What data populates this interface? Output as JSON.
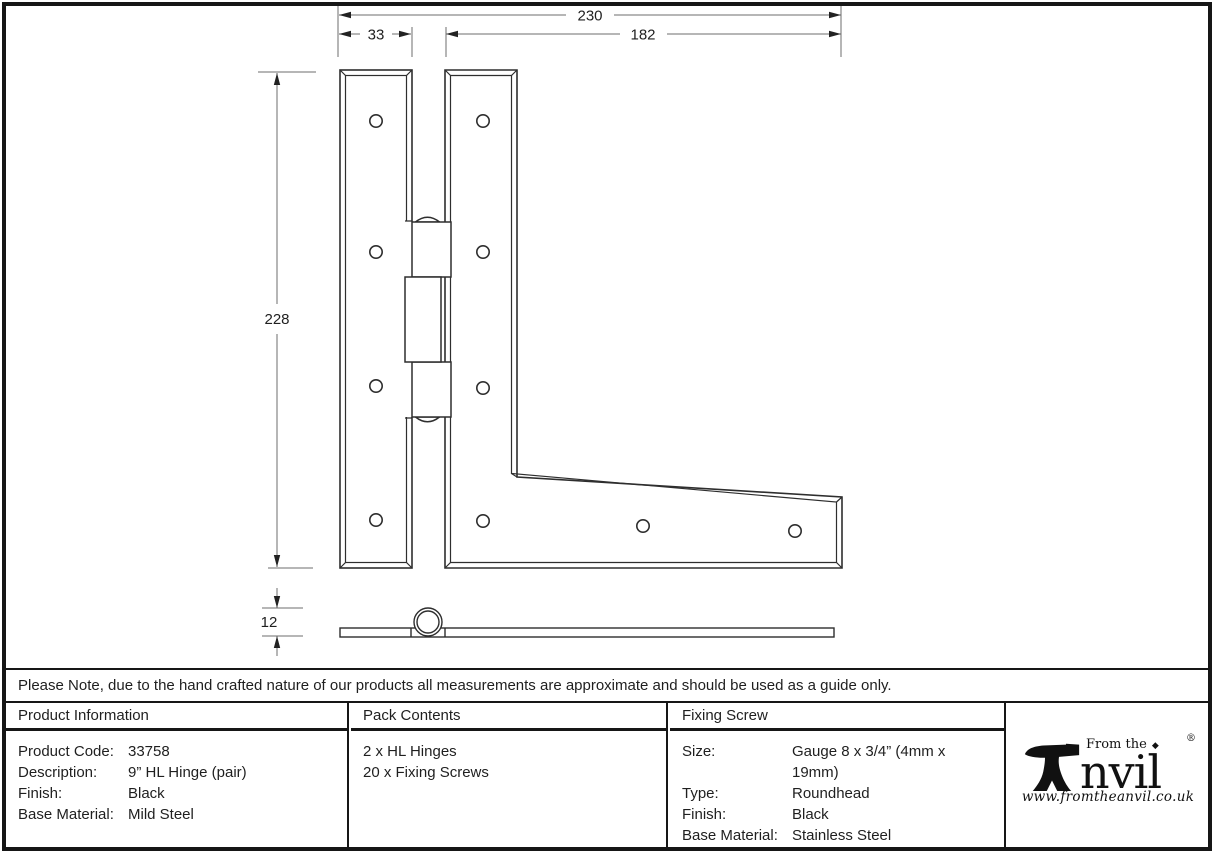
{
  "drawing": {
    "dimensions": {
      "overall_width": "230",
      "left_leaf_width": "33",
      "arm_length": "182",
      "height": "228",
      "knuckle_diameter": "12"
    }
  },
  "note": {
    "text": "Please Note, due to the hand crafted nature of our products all measurements are approximate and should be used as a guide only."
  },
  "table": {
    "product_information": {
      "header": "Product Information",
      "rows": [
        {
          "label": "Product Code:",
          "value": "33758"
        },
        {
          "label": "Description:",
          "value": "9” HL Hinge (pair)"
        },
        {
          "label": "Finish:",
          "value": "Black"
        },
        {
          "label": "Base Material:",
          "value": "Mild Steel"
        }
      ]
    },
    "pack_contents": {
      "header": "Pack Contents",
      "lines": [
        "2 x HL Hinges",
        "20 x Fixing Screws"
      ]
    },
    "fixing_screw": {
      "header": "Fixing Screw",
      "rows": [
        {
          "label": "Size:",
          "value": "Gauge 8 x 3/4” (4mm x 19mm)"
        },
        {
          "label": "Type:",
          "value": "Roundhead"
        },
        {
          "label": "Finish:",
          "value": "Black"
        },
        {
          "label": "Base Material:",
          "value": "Stainless Steel"
        }
      ]
    }
  },
  "logo": {
    "tagline": "From the",
    "brand_suffix": "nvil",
    "registered_mark": "®",
    "website": "www.fromtheanvil.co.uk"
  },
  "colors": {
    "outline": "#2e2e2e",
    "dimension_line": "#6e6e6e",
    "text": "#1f1f1f",
    "border": "#161616",
    "background": "#ffffff"
  }
}
